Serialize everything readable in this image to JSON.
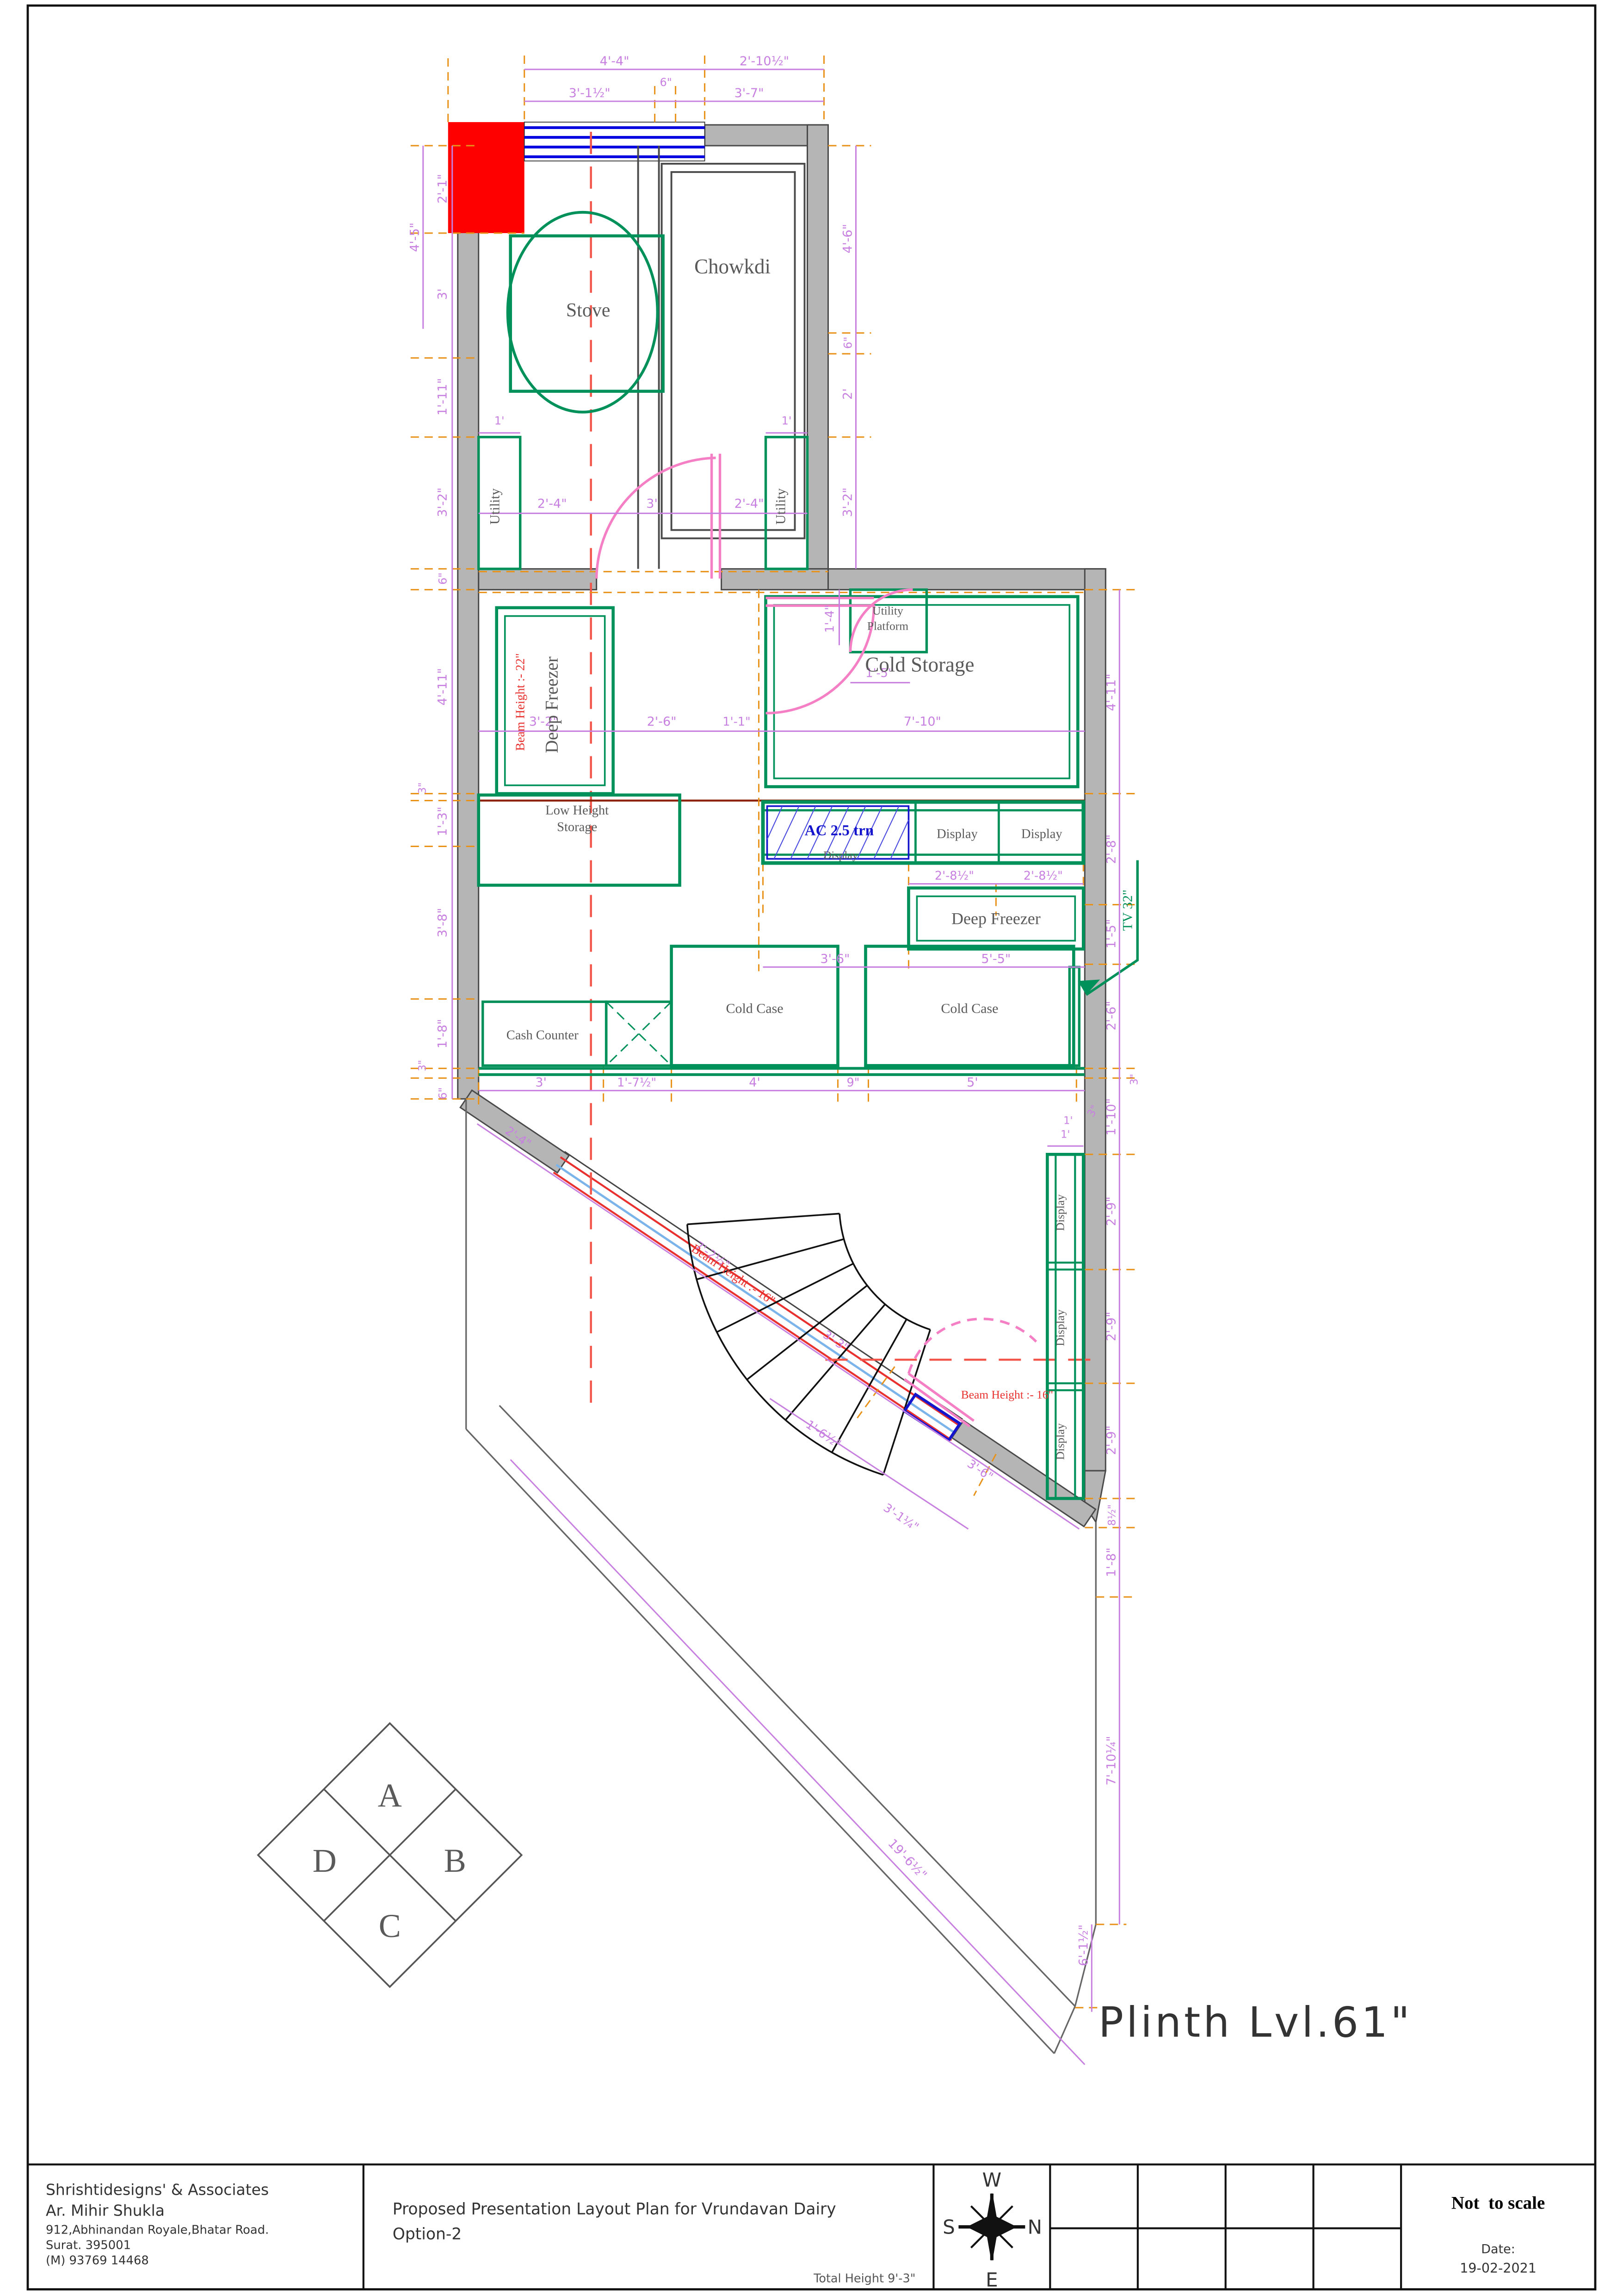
{
  "sheet": {
    "company": {
      "name": "Shrishtidesigns' & Associates",
      "architect": "Ar. Mihir Shukla",
      "address_line1": "912,Abhinandan Royale,Bhatar Road.",
      "address_line2": "Surat. 395001",
      "phone": "(M) 93769 14468"
    },
    "title_line1": "Proposed Presentation Layout Plan for Vrundavan Dairy",
    "title_line2": "Option-2",
    "total_height_note": "Total Height 9'-3\"",
    "scale_note": "Not  to scale",
    "date_label": "Date:",
    "date_value": "19-02-2021",
    "compass": {
      "top": "W",
      "left": "S",
      "right": "N",
      "bottom": "E"
    },
    "plinth_note": "Plinth Lvl.61\""
  },
  "rooms": {
    "stove": "Stove",
    "chowkdi": "Chowkdi",
    "utility_left": "Utility",
    "utility_right": "Utility",
    "utility_platform_l1": "Utility",
    "utility_platform_l2": "Platform",
    "cold_storage": "Cold Storage",
    "deep_freezer_top": "Deep Freezer",
    "low_height_l1": "Low Height",
    "low_height_l2": "Storage",
    "display_mid": "Display",
    "display_1": "Display",
    "display_2": "Display",
    "deep_freezer_low": "Deep Freezer",
    "cash_counter": "Cash Counter",
    "cold_case_1": "Cold Case",
    "cold_case_2": "Cold Case",
    "display_r1": "Display",
    "display_r2": "Display",
    "display_r3": "Display"
  },
  "annotations": {
    "ac": "AC 2.5 trn",
    "tv": "TV 32\"",
    "beam_22": "Beam Height :- 22\"",
    "beam_16_diag": "Beam Height :- 16\"",
    "beam_16_low": "Beam Height :- 16\""
  },
  "direction_diamond": {
    "a": "A",
    "b": "B",
    "c": "C",
    "d": "D"
  },
  "dims": {
    "top": [
      "4'-4\"",
      "2'-10½\"",
      "3'-1½\"",
      "6\"",
      "3'-7\""
    ],
    "left_outer": [
      "4'-5\""
    ],
    "left": [
      "2'-1\"",
      "3'",
      "1'-11\"",
      "3'-2\"",
      "6\"",
      "4'-11\"",
      "3\"",
      "1'-3\"",
      "3'-8\"",
      "1'-8\"",
      "3\"",
      "6\""
    ],
    "right_inner": [
      "4'-6\"",
      "6\"",
      "2'",
      "3'-2\""
    ],
    "right_outer": [
      "4'-11\"",
      "2'-8\"",
      "1'-5\"",
      "2'-6\"",
      "3\"",
      "1'-10\"",
      "1'",
      "2'-9\"",
      "2'-9\"",
      "2'-9\"",
      "8½\"",
      "1'-8\"",
      "7'-10¼\"",
      "6'-1½\""
    ],
    "utility_row": [
      "1'",
      "2'-4\"",
      "3'",
      "2'-4\"",
      "1'"
    ],
    "platform": [
      "1'-4\"",
      "1'-5\""
    ],
    "storage_row": [
      "3'-2\"",
      "2'-6\"",
      "1'-1\"",
      "7'-10\""
    ],
    "display_row": [
      "2'-8½\"",
      "2'-8½\""
    ],
    "freezer_row": [
      "3'-6\"",
      "5'-5\""
    ],
    "counter_row": [
      "3'",
      "1'-7½\"",
      "4'",
      "9\"",
      "5'",
      "3\"",
      "1'"
    ],
    "diagonal": [
      "2'-4\"",
      "7'-2½\"",
      "3'-3\"",
      "3'-6\"",
      "1'-6½\"",
      "3'-1¼\""
    ],
    "boundary": [
      "19'-6½\""
    ]
  }
}
